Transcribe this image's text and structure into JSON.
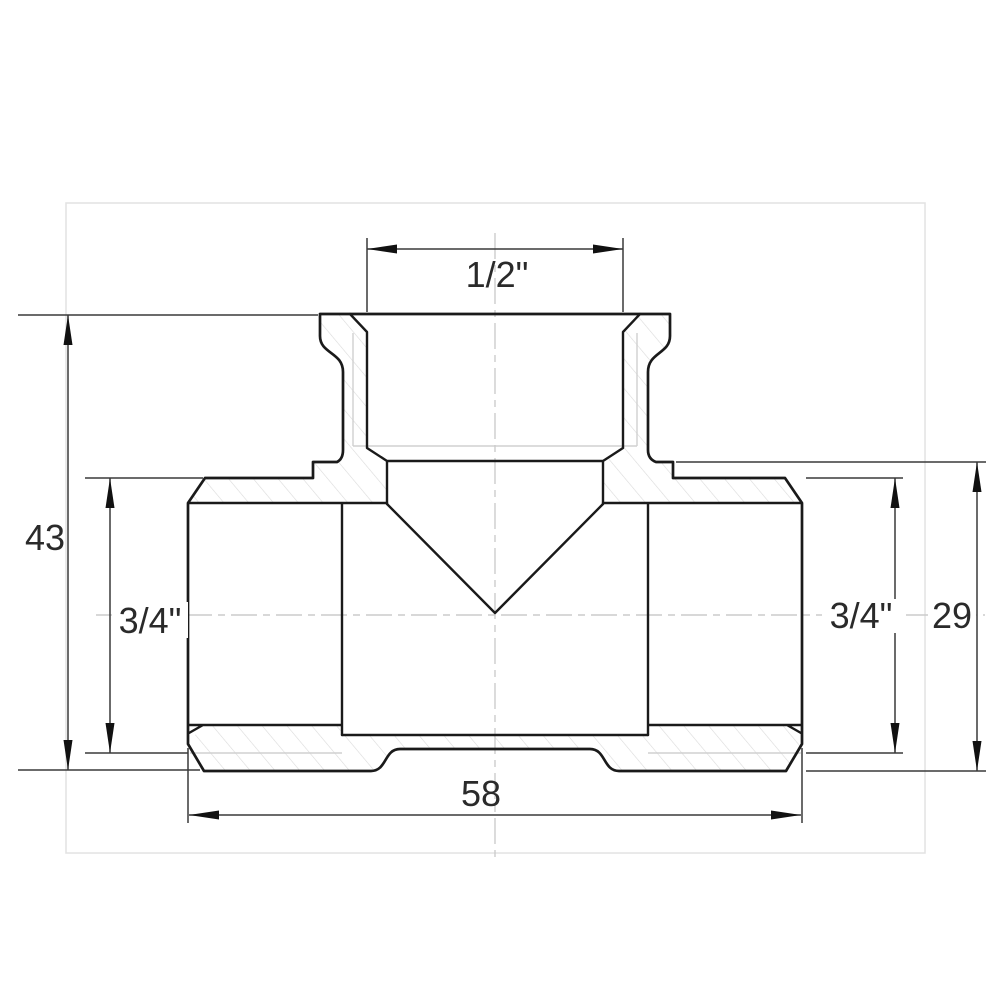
{
  "drawing": {
    "dimensions": {
      "top_width": "1/2\"",
      "overall_height": "43",
      "left_port": "3/4\"",
      "right_port": "3/4\"",
      "right_end_height": "29",
      "overall_width": "58"
    },
    "colors": {
      "outline": "#1a1a1a",
      "dimension_lines": "#3a3a3a",
      "thread_thin_lines": "#d0d0d0",
      "hatch": "#dadada",
      "centerline": "#cccccc",
      "frame": "#e2e2e2",
      "background": "#ffffff"
    }
  }
}
